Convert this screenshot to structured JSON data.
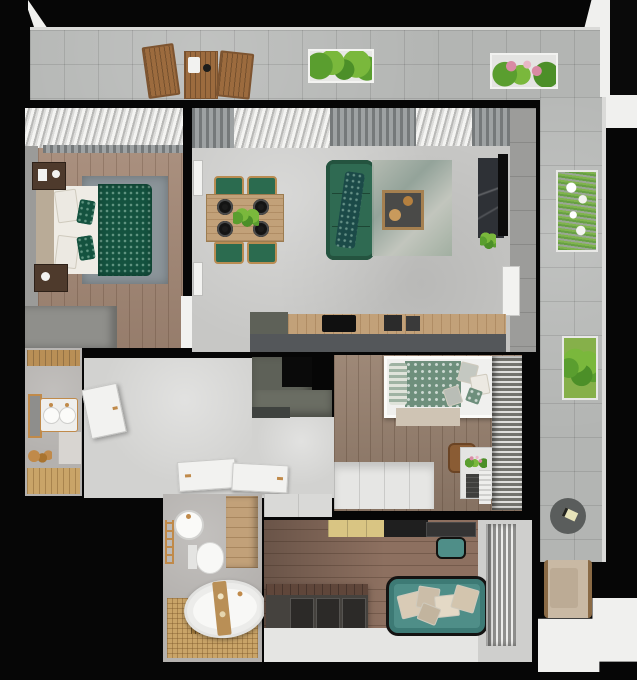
{
  "meta": {
    "title": "3D Apartment Floor Plan — Top-Down Render",
    "canvas_width": 637,
    "canvas_height": 680,
    "render_style": "photorealistic top view, black wall mass, L-shaped balcony",
    "visible_text": "none"
  },
  "colors": {
    "wall": "#060606",
    "tile": "#b3b5b3",
    "parapet": "#dadad8",
    "concrete": "#c7c7c5",
    "hallFloor": "#d2d2d0",
    "bathWall": "#b4b1ae",
    "woodBedroom": "#a78b78",
    "woodBedroom2": "#98816f",
    "woodLounge": "#8d7060",
    "woodCounter": "#c2a179",
    "woodBalconyFurniture": "#9c6b3e",
    "woodShelf": "#b98f56",
    "mosaic": "#c9a468",
    "cabinetDark": "#5e6158",
    "counterFront": "#54575a",
    "marble": "#2e3136",
    "sofaGreen": "#2f6a52",
    "blanketGreen": "#14523f",
    "chairGreen": "#2b6b4f",
    "bedding2Green": "#6e8f7c",
    "sofaTeal": "#4f8e88",
    "rugGray": "#8b9499",
    "rugLiving": "#aab3a7",
    "rugBeige": "#cfc4b4",
    "gold": "#c08a4a",
    "white": "#f2f2f0",
    "offWhite": "#e6e6e4",
    "plantGreen": "#5a9e2f",
    "plantGreenLight": "#7ab83c",
    "flowerPink": "#d98ba4",
    "curtainGray": "#83878a",
    "nightstand": "#4e3a2c",
    "storageDark": "#45423e",
    "exterior": "#f0f0ee"
  },
  "rooms": {
    "balconyTop": {
      "label": "Balcony terrace (top run)"
    },
    "balconyRight": {
      "label": "Balcony terrace (right wing)"
    },
    "bedroom1": {
      "label": "Master bedroom"
    },
    "livingDining": {
      "label": "Open living and dining room"
    },
    "kitchen": {
      "label": "Kitchen counter run"
    },
    "hallway": {
      "label": "Hallway"
    },
    "wc": {
      "label": "Guest washroom"
    },
    "bedroom2": {
      "label": "Second bedroom"
    },
    "bathroom": {
      "label": "Main bathroom"
    },
    "lounge": {
      "label": "Lounge / study"
    },
    "exterior": {
      "label": "Building exterior"
    }
  },
  "furniture": {
    "balcony": {
      "chairLeft": "Wooden folding chair",
      "table": "Wooden folding table with white tray",
      "chairRight": "Wooden folding chair",
      "planterHerbs": "White planter box with green plants",
      "planterFlowers": "White planter box with pink flowers",
      "planterGrass": "Planter with tall grass and white flowers",
      "planterGreen": "Planter with green shrubs",
      "sideTable": "Round dark side table",
      "armchair": "Beige outdoor armchair"
    },
    "bedroom1": {
      "curtain": "Sheer window drape",
      "bed": "Double bed with green patterned duvet",
      "rug": "Gray area rug",
      "nightstandTop": "Dark wood nightstand",
      "nightstandBottom": "Dark wood nightstand",
      "wardrobe": "Built-in wardrobe block",
      "door": "White door opening"
    },
    "livingDining": {
      "diningTable": "Wooden dining table for four",
      "diningChair": "Green upholstered dining chair",
      "centerpiece": "Green plant centerpiece",
      "plate": "Black charger plate setting",
      "sofa": "Green three-seat sofa with patterned throw",
      "rug": "Distressed green-gray rug",
      "coffeeTable": "Square coffee table with round trays",
      "tvWall": "Dark marble TV wall",
      "tv": "Wall-mounted TV",
      "plant": "Potted plant under TV",
      "frame": "White wall frame",
      "doorRight": "White balcony door"
    },
    "kitchen": {
      "tallCabinet": "Tall cabinet block",
      "counter": "Wooden worktop",
      "cooktop": "Black cooktop",
      "appliance": "Countertop appliance",
      "counterFront": "Gray cabinet front",
      "island": "L-shaped dark cabinet unit"
    },
    "hallway": {
      "doorOpen": "Open white entry door",
      "doorFlat1": "Open door leaf to bathroom",
      "doorFlat2": "Open door leaf to bedroom",
      "mat": "Dark floor mat"
    },
    "wc": {
      "shelf": "Wooden shelf",
      "mirror": "Brass framed mirror",
      "vanity": "Twin round basins with brass taps",
      "towelRack": "Brass towel rack with accessories",
      "shelving": "White shelving",
      "floor": "Wooden floor strip"
    },
    "bedroom2": {
      "bed": "Bed with green patterned bedding and pillows",
      "rug": "Beige runner rug",
      "dresser": "Low white dresser unit",
      "chair": "Brown chair",
      "desk": "White desk with flowers",
      "crate": "Dark storage crate",
      "radiator": "White radiator",
      "wardrobe": "Slatted-front wardrobe"
    },
    "bathroom": {
      "sink": "Round basin with brass tap",
      "rack": "Brass ladder rack",
      "toilet": "Wall-hung toilet",
      "cabinet": "Light wood tall cabinet",
      "tub": "Freestanding oval bathtub",
      "caddy": "Wooden bath caddy",
      "floor": "Wood mosaic floor with linear drain"
    },
    "lounge": {
      "wallPanel": "White wall panel",
      "sideboard": "Light wood sideboard",
      "desk": "Dark desk unit",
      "chair": "Teal desk chair",
      "storage": "Dark storage media unit",
      "sofa": "Teal sofa with beige cushions",
      "blinds": "Vertical blinds at window"
    }
  }
}
